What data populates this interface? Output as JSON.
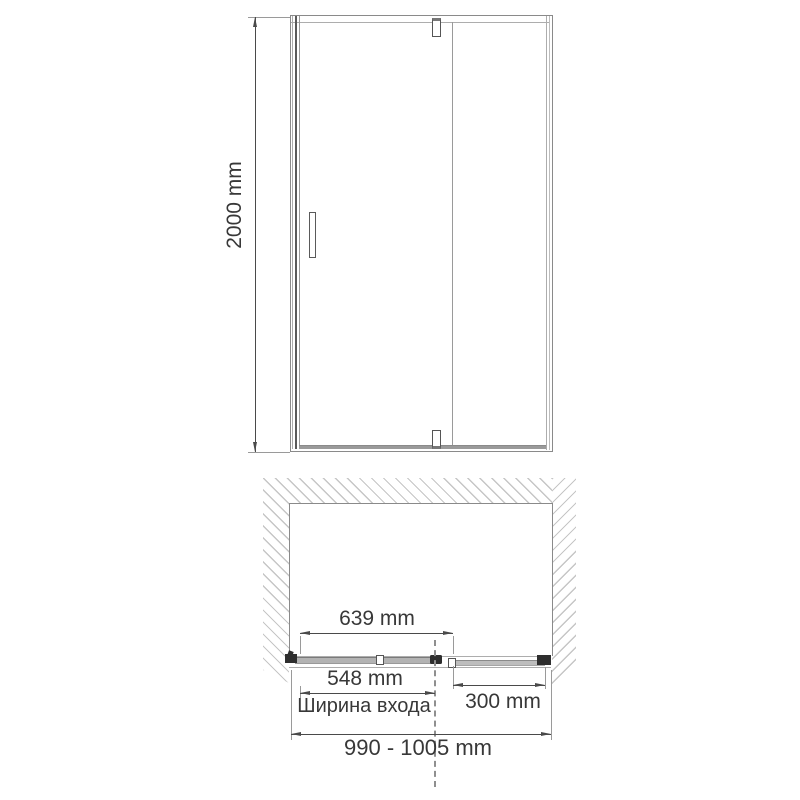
{
  "drawing_title": "shower-door-installation-diagram",
  "view_front": {
    "height_label": "2000 mm"
  },
  "view_plan": {
    "door_glass_width_label": "639 mm",
    "entrance_width_label": "548 mm",
    "entrance_width_caption": "Ширина входа",
    "fixed_panel_width_label": "300 mm",
    "overall_width_label": "990 - 1005 mm"
  },
  "colors": {
    "line": "#8a8a8a",
    "line_light": "#adadad",
    "dim": "#4a4a4a",
    "text": "#383838",
    "hatch": "#c6c6c6",
    "hardware": "#2e2e2e",
    "glass": "#b3b3b3"
  }
}
